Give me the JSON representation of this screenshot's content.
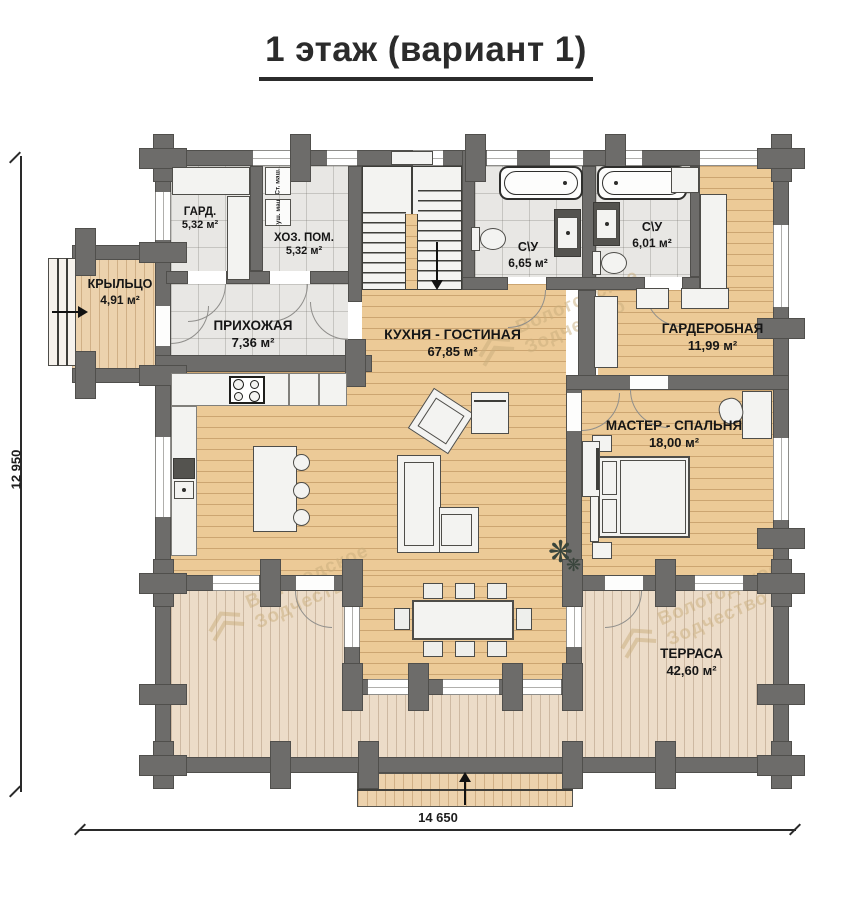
{
  "title": "1 этаж (вариант 1)",
  "dimensions": {
    "bottom": "14 650",
    "left": "12 950"
  },
  "watermark": {
    "line1": "Вологодское",
    "line2": "Зодчество"
  },
  "rooms": {
    "gard": {
      "name": "ГАРД.",
      "area": "5,32 м²"
    },
    "hoz": {
      "name": "ХОЗ. ПОМ.",
      "area": "5,32 м²"
    },
    "kryltso": {
      "name": "КРЫЛЬЦО",
      "area": "4,91 м²"
    },
    "prihozhaya": {
      "name": "ПРИХОЖАЯ",
      "area": "7,36 м²"
    },
    "kitchen": {
      "name": "КУХНЯ - ГОСТИНАЯ",
      "area": "67,85 м²"
    },
    "su1": {
      "name": "С\\У",
      "area": "6,65 м²"
    },
    "su2": {
      "name": "С\\У",
      "area": "6,01 м²"
    },
    "garderobnaya": {
      "name": "ГАРДЕРОБНАЯ",
      "area": "11,99 м²"
    },
    "master": {
      "name": "МАСТЕР - СПАЛЬНЯ",
      "area": "18,00 м²"
    },
    "terrasa": {
      "name": "ТЕРРАСА",
      "area": "42,60 м²"
    }
  },
  "appliances": {
    "washer": "Ст. маш.",
    "dryer": "Суш. маш."
  },
  "colors": {
    "wall": "#6d6c6a",
    "wood_floor": "#ecca97",
    "terrace_deck": "#ecdcc8",
    "tile_floor": "#e8e7e4",
    "title_text": "#2b2b2b"
  }
}
